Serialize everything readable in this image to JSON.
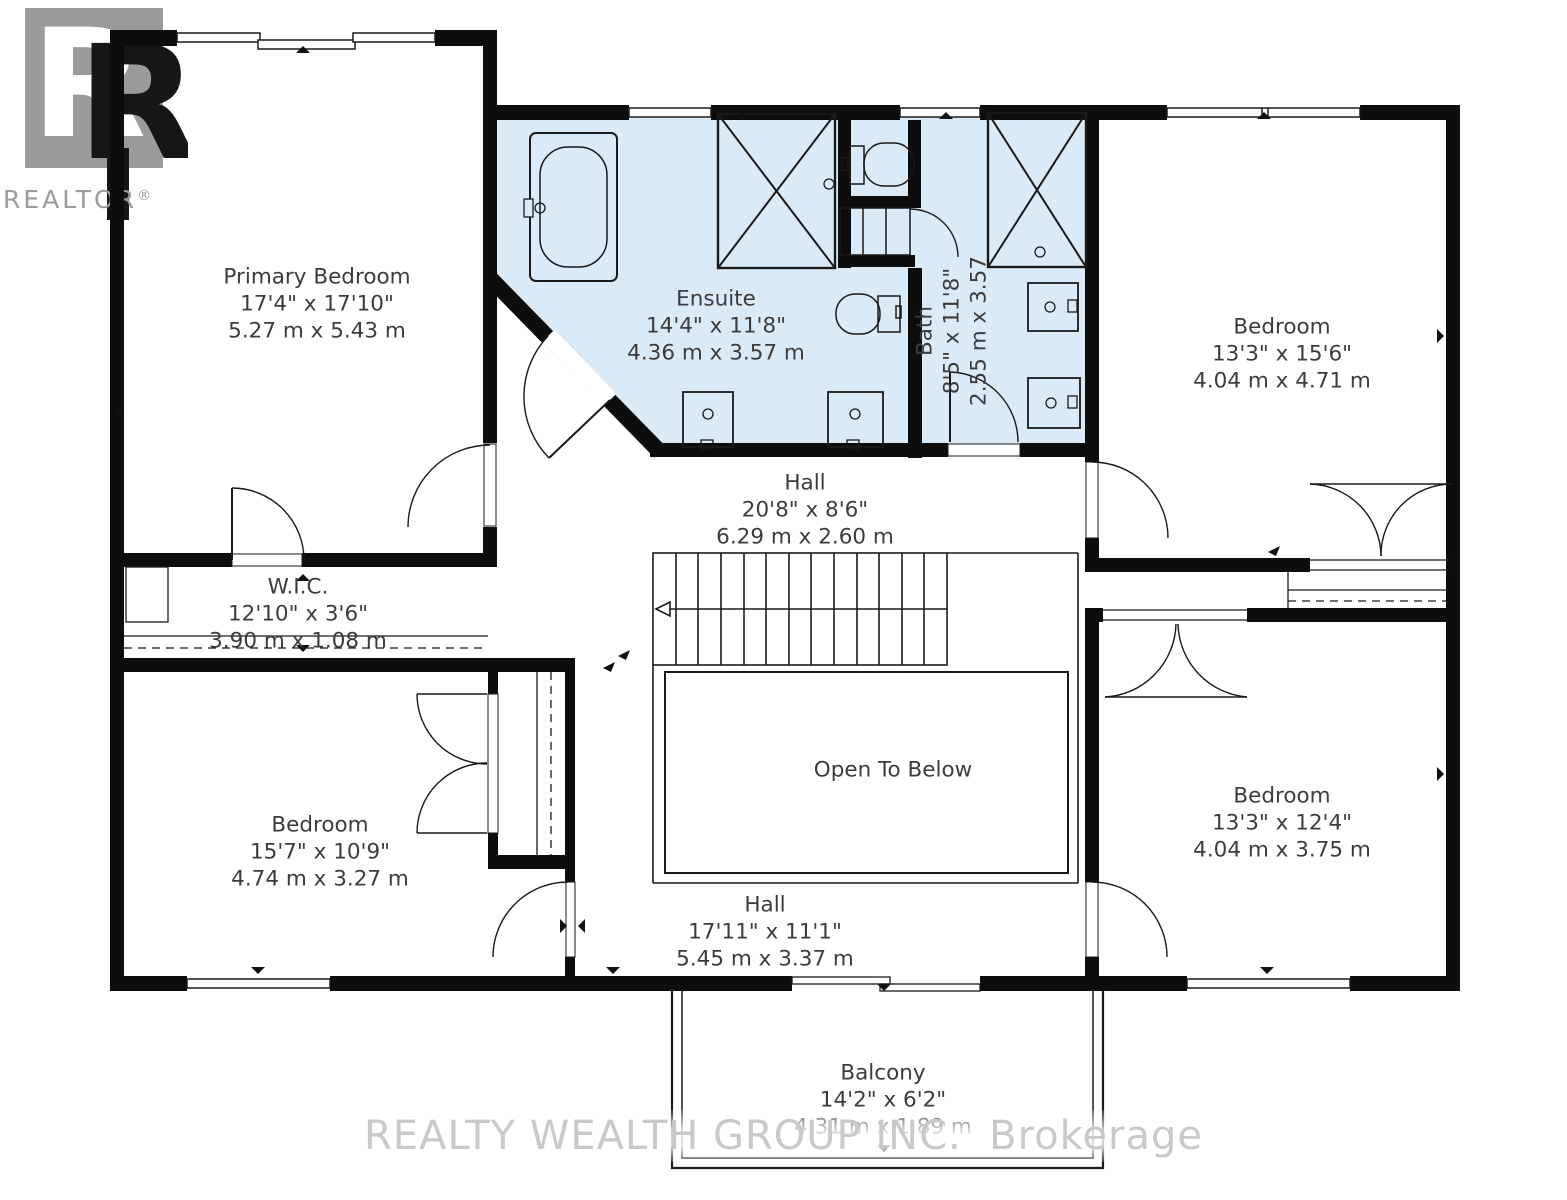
{
  "logo": {
    "letter": "R",
    "wordmark": "REALTOR",
    "reg": "®"
  },
  "watermark": {
    "text": "REALTY WEALTH GROUP INC.  Brokerage"
  },
  "rooms": {
    "primary_bedroom": {
      "name": "Primary Bedroom",
      "dim_ft": "17'4\" x 17'10\"",
      "dim_m": "5.27 m x 5.43 m"
    },
    "ensuite": {
      "name": "Ensuite",
      "dim_ft": "14'4\" x 11'8\"",
      "dim_m": "4.36 m x 3.57 m"
    },
    "bath": {
      "name": "Bath",
      "dim_ft": "8'5\" x 11'8\"",
      "dim_m": "2.55 m x 3.57"
    },
    "bedroom_ne": {
      "name": "Bedroom",
      "dim_ft": "13'3\" x 15'6\"",
      "dim_m": "4.04 m x 4.71 m"
    },
    "hall_upper": {
      "name": "Hall",
      "dim_ft": "20'8\" x 8'6\"",
      "dim_m": "6.29 m x 2.60 m"
    },
    "wic": {
      "name": "W.I.C.",
      "dim_ft": "12'10\" x 3'6\"",
      "dim_m": "3.90 m x 1.08 m"
    },
    "bedroom_sw": {
      "name": "Bedroom",
      "dim_ft": "15'7\" x 10'9\"",
      "dim_m": "4.74 m x 3.27 m"
    },
    "open_to_below": {
      "name": "Open To Below"
    },
    "bedroom_se": {
      "name": "Bedroom",
      "dim_ft": "13'3\" x 12'4\"",
      "dim_m": "4.04 m x 3.75 m"
    },
    "hall_lower": {
      "name": "Hall",
      "dim_ft": "17'11\" x 11'1\"",
      "dim_m": "5.45 m x 3.37 m"
    },
    "balcony": {
      "name": "Balcony",
      "dim_ft": "14'2\" x 6'2\"",
      "dim_m": "4.31 m x 1.89 m"
    }
  },
  "colors": {
    "wall": "#0d0d0d",
    "wet_room_fill": "#dbeaf7",
    "label_text": "#3c3c3c",
    "logo_gray": "#9b9b9b",
    "watermark_gray": "#c9c9c9"
  }
}
